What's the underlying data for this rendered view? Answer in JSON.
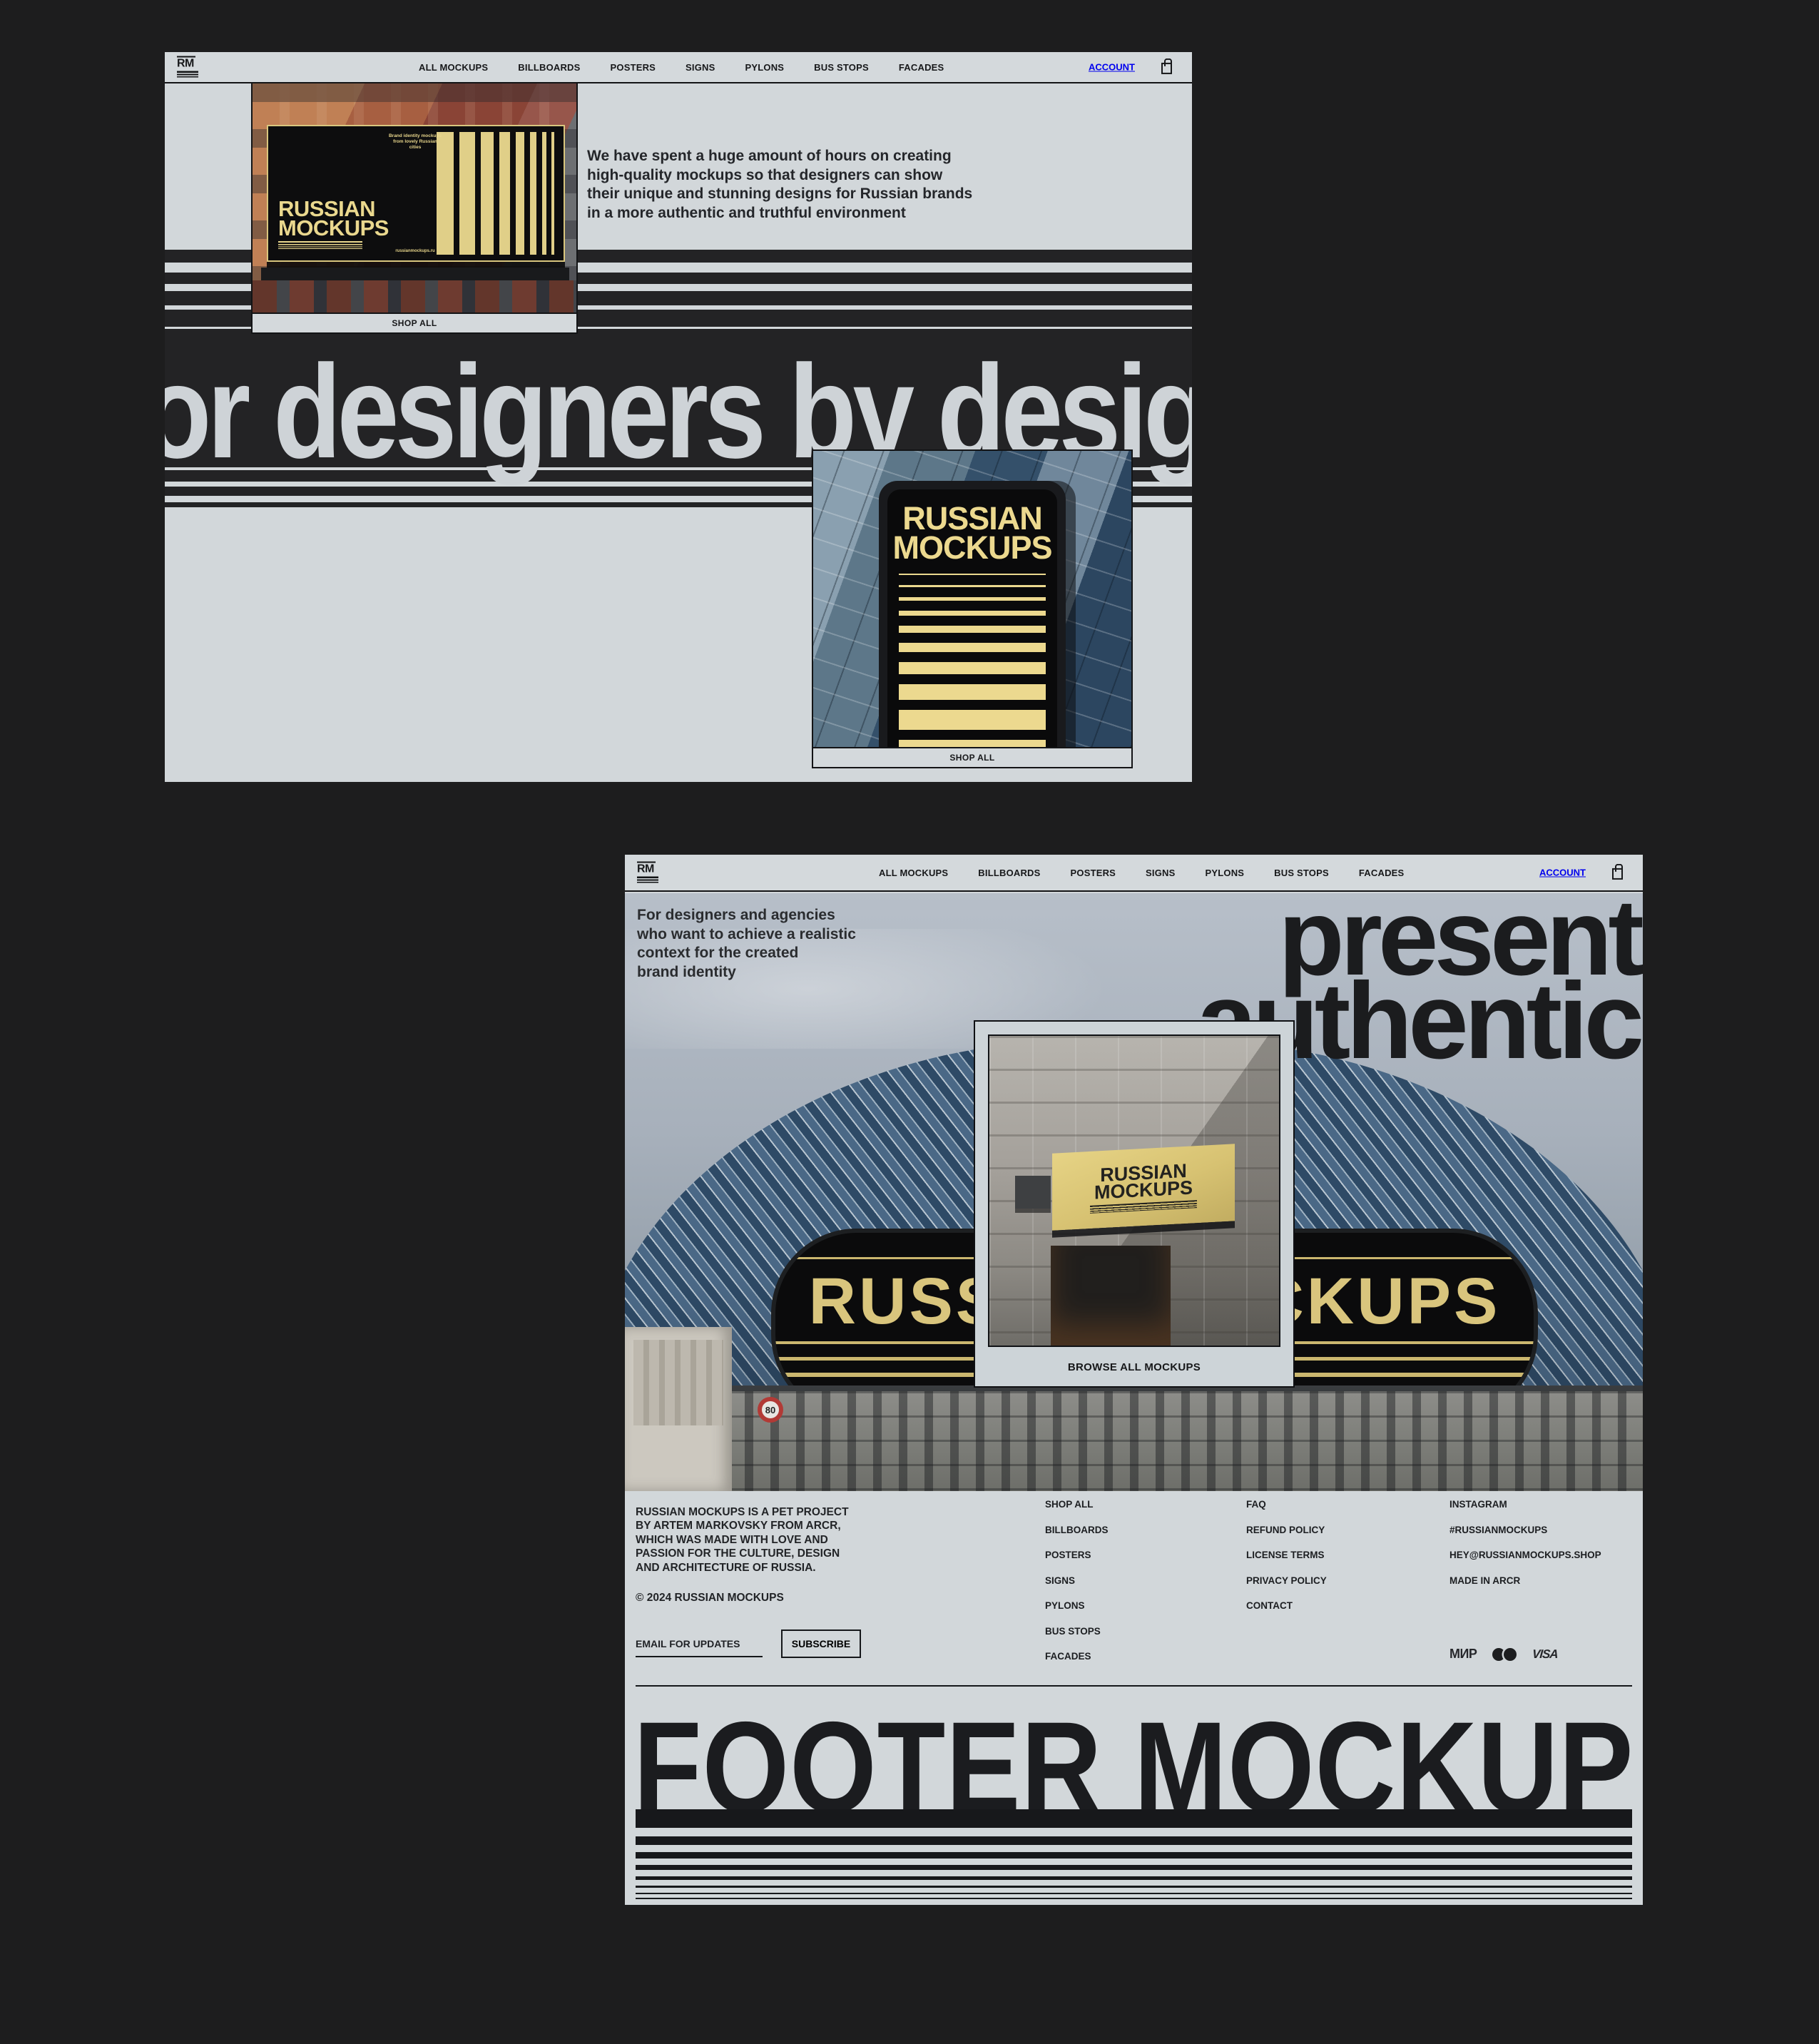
{
  "colors": {
    "canvas_bg": "#1d1d1e",
    "page_bg": "#d2d7da",
    "ink": "#17181a",
    "cream": "#ecd98f",
    "arena_gold": "#d9c57d",
    "big_text_gray": "#ced3d7"
  },
  "nav": {
    "logo": "RM",
    "items": [
      "ALL MOCKUPS",
      "BILLBOARDS",
      "POSTERS",
      "SIGNS",
      "PYLONS",
      "BUS STOPS",
      "FACADES"
    ],
    "account": "ACCOUNT",
    "cart_icon": "shopping-bag-icon"
  },
  "top_page": {
    "paragraph": "We have spent a huge amount of hours on creating\nhigh-quality mockups so that designers can show\ntheir unique and stunning designs for Russian brands\nin a more authentic and truthful environment",
    "big_text": "or designers by desigr",
    "billboard": {
      "brand_line1": "RUSSIAN",
      "brand_line2": "MOCKUPS",
      "tagline": "Brand identity mockups\nfrom lovely Russian\ncities",
      "url": "russianmockups.ru",
      "shop_all": "SHOP ALL"
    },
    "pylon": {
      "brand_line1": "RUSSIAN",
      "brand_line2": "MOCKUPS",
      "shop_all": "SHOP ALL"
    }
  },
  "bottom_page": {
    "intro": "For designers and agencies\nwho want to achieve a realistic\ncontext for the created\nbrand identity",
    "headline_line1": "present",
    "headline_line2": "authentic",
    "arena_text": "RUSSIAN MOCKUPS",
    "speed_sign": "80",
    "overlay_card": {
      "sign_line1": "RUSSIAN",
      "sign_line2": "MOCKUPS",
      "browse_label": "BROWSE ALL MOCKUPS"
    },
    "footer": {
      "about": "RUSSIAN MOCKUPS  IS A PET PROJECT\nBY ARTEM MARKOVSKY FROM ARCR,\nWHICH WAS MADE WITH LOVE AND\nPASSION FOR THE CULTURE, DESIGN\nAND ARCHITECTURE OF RUSSIA.",
      "copyright": "© 2024 RUSSIAN MOCKUPS",
      "columns": [
        {
          "items": [
            "SHOP ALL",
            "BILLBOARDS",
            "POSTERS",
            "SIGNS",
            "PYLONS",
            "BUS STOPS",
            "FACADES"
          ]
        },
        {
          "items": [
            "FAQ",
            "REFUND POLICY",
            "LICENSE TERMS",
            "PRIVACY POLICY",
            "CONTACT"
          ]
        },
        {
          "items": [
            "INSTAGRAM",
            "#RUSSIANMOCKUPS",
            "HEY@RUSSIANMOCKUPS.SHOP",
            "MADE IN ARCR"
          ]
        }
      ],
      "email_label": "EMAIL FOR UPDATES",
      "subscribe_label": "SUBSCRIBE",
      "payments": {
        "mir": "МИР",
        "visa": "VISA",
        "mastercard_icon": "mastercard-circles-icon"
      },
      "giant_text": "FOOTER MOCKUP"
    }
  }
}
